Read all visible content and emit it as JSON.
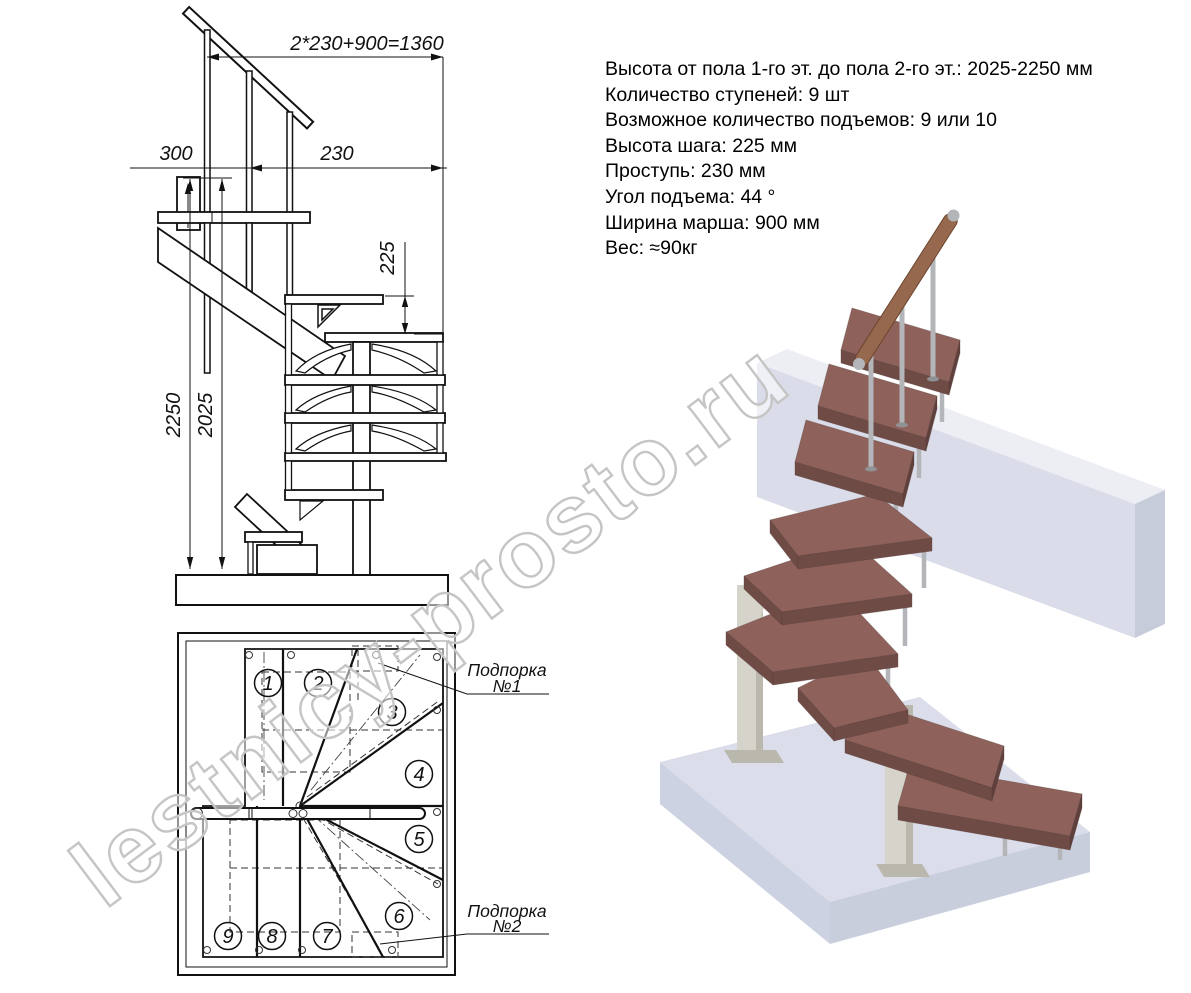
{
  "watermark": {
    "text": "lestnicy-prosto.ru"
  },
  "specs": {
    "lines": [
      "Высота от пола 1-го эт. до пола 2-го эт.: 2025-2250 мм",
      "Количество ступеней: 9 шт",
      "Возможное количество подъемов: 9 или 10",
      "Высота шага: 225 мм",
      "Проступь: 230 мм",
      "Угол подъема: 44 °",
      "Ширина марша: 900 мм",
      "Вес: ≈90кг"
    ]
  },
  "elevation": {
    "dim_total": "2*230+900=1360",
    "dim_offset": "300",
    "dim_tread": "230",
    "dim_rise": "225",
    "dim_height_max": "2250",
    "dim_height_min": "2025"
  },
  "plan": {
    "steps": [
      "1",
      "2",
      "3",
      "4",
      "5",
      "6",
      "7",
      "8",
      "9"
    ],
    "support1_line1": "Подпорка",
    "support1_line2": "№1",
    "support2_line1": "Подпорка",
    "support2_line2": "№2"
  },
  "colors": {
    "line": "#1a1a1a",
    "tread_top": "#8e625b",
    "tread_front": "#6f4b46",
    "tread_end": "#5f403c",
    "wood_rail": "#96684e",
    "wood_rail_edge": "#6d452f",
    "metal": "#b3b5b9",
    "metal_dark": "#8f9194",
    "column": "#d6d3ca",
    "column_shade": "#bab7ad",
    "slab_top": "#dbdeea",
    "slab_left": "#cdd2e2",
    "slab_right": "#c9cedd",
    "beam_top": "#eceef4",
    "beam_front": "#dadde9",
    "beam_end": "#c7ccdb",
    "watermark": "#c5c5c5"
  }
}
